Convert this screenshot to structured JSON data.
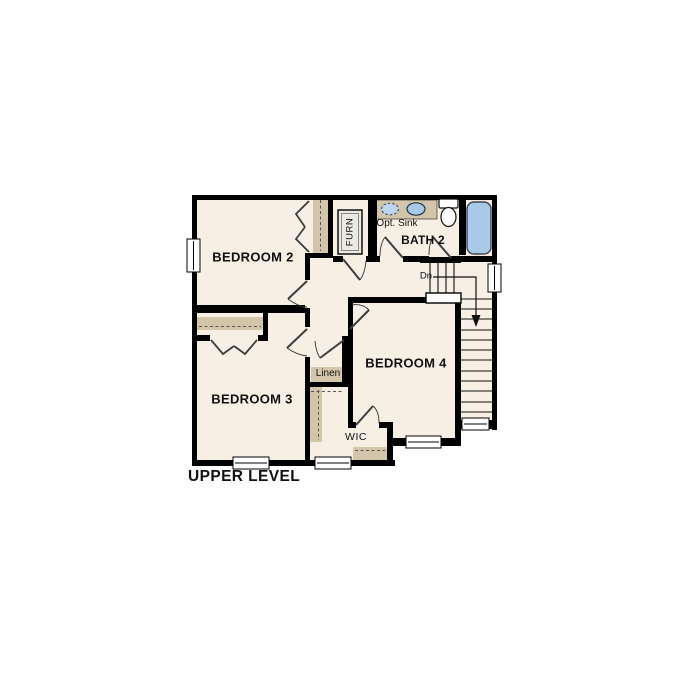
{
  "title": {
    "text": "UPPER LEVEL"
  },
  "rooms": {
    "bedroom2": "BEDROOM 2",
    "bedroom3": "BEDROOM 3",
    "bedroom4": "BEDROOM 4",
    "bath2": "BATH 2"
  },
  "annotations": {
    "opt_sink": "Opt. Sink",
    "linen": "Linen",
    "wic": "WIC",
    "furn": "FURN",
    "stairs_down": "Dn"
  },
  "colors": {
    "floor": "#f7efe3",
    "wall": "#000000",
    "casework": "#d3c5aa",
    "fixture_blue": "#a9c9e9",
    "optional_fixture_blue": "#bdd5ee",
    "door_leaf": "#3d3d3d",
    "background": "#ffffff"
  }
}
